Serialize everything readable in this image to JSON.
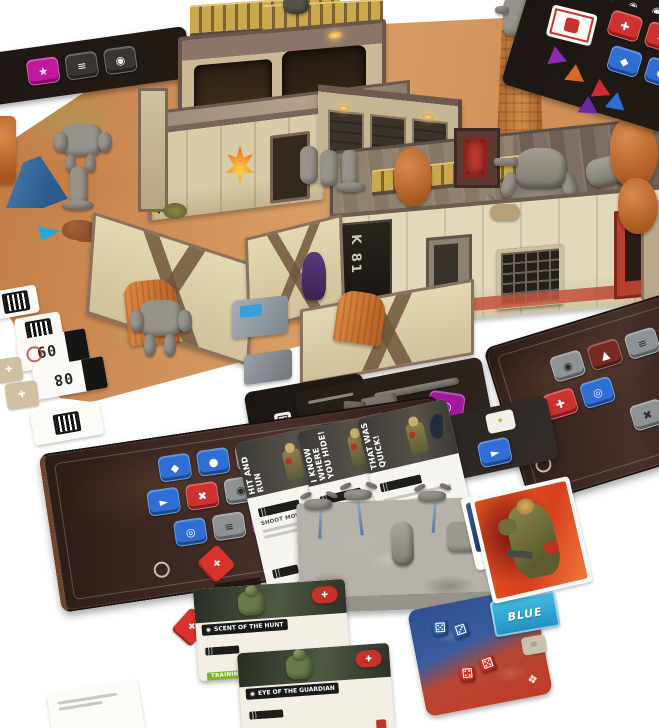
{
  "signs": {
    "building": "K 81"
  },
  "mission_cards": [
    {
      "title": "HIT AND RUN",
      "line": "SHOOT MOVE 2",
      "footer": "MOVE 2"
    },
    {
      "title": "I KNOW WHERE YOU HIDE!",
      "line": "",
      "footer": "MOVE 2"
    },
    {
      "title": "THAT WAS QUICK!",
      "line": "",
      "footer": "MOVE 2"
    }
  ],
  "ability_cards": [
    {
      "title": "SCENT OF THE HUNT",
      "chip": "TRAINING 1"
    },
    {
      "title": "EYE OF THE GUARDIAN",
      "chip": "TRAINING 1"
    }
  ],
  "cards": {
    "blue_label": "BLUE",
    "ammo_numbers": [
      "09",
      "08"
    ]
  },
  "colors": {
    "mat_sand": "#d99e66",
    "dashboard_brown": "#36241d",
    "chip_blue": "#2f6fd4",
    "chip_red": "#d03030",
    "chip_magenta": "#b5179e",
    "chip_grey": "#8f9294",
    "accent_red": "#c8302a",
    "training_green": "#7cb52c",
    "blue_card_cyan": "#2fa9d8",
    "dice_mat_blue": "#2e4f92",
    "dice_mat_red": "#c23a28",
    "gold_railing": "#c9a84e"
  },
  "chips": {
    "bottom_left_r1": [
      {
        "name": "chip-shield-icon",
        "glyph": "◆",
        "color": "#2f6fd4"
      },
      {
        "name": "chip-gear-icon",
        "glyph": "●",
        "color": "#2f6fd4"
      },
      {
        "name": "chip-grid-icon",
        "glyph": "≡",
        "color": "#8f9294",
        "fg": "#2b2b2b"
      },
      {
        "name": "chip-cross-icon",
        "glyph": "✚",
        "color": "#2f6fd4"
      }
    ],
    "bottom_left_r2": [
      {
        "name": "chip-arrow-icon",
        "glyph": "►",
        "color": "#2f6fd4"
      },
      {
        "name": "chip-x-icon",
        "glyph": "✖",
        "color": "#d03030"
      },
      {
        "name": "chip-target-icon",
        "glyph": "◉",
        "color": "#8f9294",
        "fg": "#2b2b2b"
      },
      {
        "name": "chip-dot-icon",
        "glyph": "●",
        "color": "#8f9294",
        "fg": "#2b2b2b"
      }
    ],
    "bottom_left_r3": [
      {
        "name": "chip-scope-icon",
        "glyph": "◎",
        "color": "#2f6fd4"
      },
      {
        "name": "chip-bars-icon",
        "glyph": "≡",
        "color": "#8f9294",
        "fg": "#2b2b2b"
      },
      {
        "name": "chip-star-icon",
        "glyph": "★",
        "color": "#b5179e"
      },
      {
        "name": "chip-anchor-icon",
        "glyph": "►",
        "color": "#2256a8",
        "w": 38
      }
    ],
    "right_r1": [
      {
        "name": "chip-target-icon",
        "glyph": "◉",
        "color": "#8f9294",
        "fg": "#2b2b2b"
      },
      {
        "name": "chip-pattern-icon",
        "glyph": "▲",
        "color": "#7a2a22"
      },
      {
        "name": "chip-bars-icon",
        "glyph": "≡",
        "color": "#8f9294",
        "fg": "#2b2b2b"
      }
    ],
    "right_r2": [
      {
        "name": "chip-cross-icon",
        "glyph": "✚",
        "color": "#d03030"
      },
      {
        "name": "chip-frame-icon",
        "glyph": "◎",
        "color": "#2f6fd4"
      }
    ],
    "right_r3": [
      {
        "name": "chip-wrench-icon",
        "glyph": "✖",
        "color": "#8f9294",
        "fg": "#2b2b2b"
      }
    ],
    "top_board_r1": [
      {
        "name": "chip-ammo-icon",
        "glyph": "✚",
        "color": "#d03030"
      },
      {
        "name": "chip-dot-icon",
        "glyph": "✖",
        "color": "#d03030"
      },
      {
        "name": "chip-ring-icon",
        "glyph": "◎",
        "color": "transparent"
      }
    ],
    "top_board_r2": [
      {
        "name": "chip-shield-icon",
        "glyph": "◆",
        "color": "#2f6fd4"
      },
      {
        "name": "chip-gear-icon",
        "glyph": "●",
        "color": "#2f6fd4"
      }
    ],
    "left_board": [
      {
        "name": "chip-star-icon",
        "glyph": "★",
        "color": "#c2189e"
      },
      {
        "name": "chip-bars-icon",
        "glyph": "≡",
        "color": "#3a3432"
      },
      {
        "name": "chip-target-icon",
        "glyph": "◉",
        "color": "#3a3432"
      }
    ],
    "weapon_row": [
      {
        "name": "chip-ammo-icon",
        "glyph": "✚",
        "color": "#c23329",
        "w": 18
      },
      {
        "name": "chip-blank-icon",
        "glyph": "",
        "color": "#ddd8cf",
        "w": 18
      },
      {
        "name": "chip-dark-icon",
        "glyph": "●",
        "color": "#44403a",
        "w": 18
      }
    ],
    "top_strip": [
      {
        "name": "round-icon",
        "glyph": "◉"
      },
      {
        "name": "round-icon",
        "glyph": "◉"
      },
      {
        "name": "round-icon",
        "glyph": "◉"
      },
      {
        "name": "round-icon",
        "glyph": "◉"
      },
      {
        "name": "round-icon",
        "glyph": "◉"
      }
    ]
  },
  "dice": {
    "blue_faces": [
      "⚄",
      "⚂"
    ],
    "red_faces": [
      "⚃",
      "⚄"
    ],
    "shield_icon": "◈",
    "burst_icon": "❖"
  },
  "token_glyphs": {
    "tan_cross": "✚",
    "diamond_cross": "✚",
    "grey_token": "≡",
    "lime_token": "✦",
    "pistol": "►",
    "hex_ring": "◎"
  }
}
